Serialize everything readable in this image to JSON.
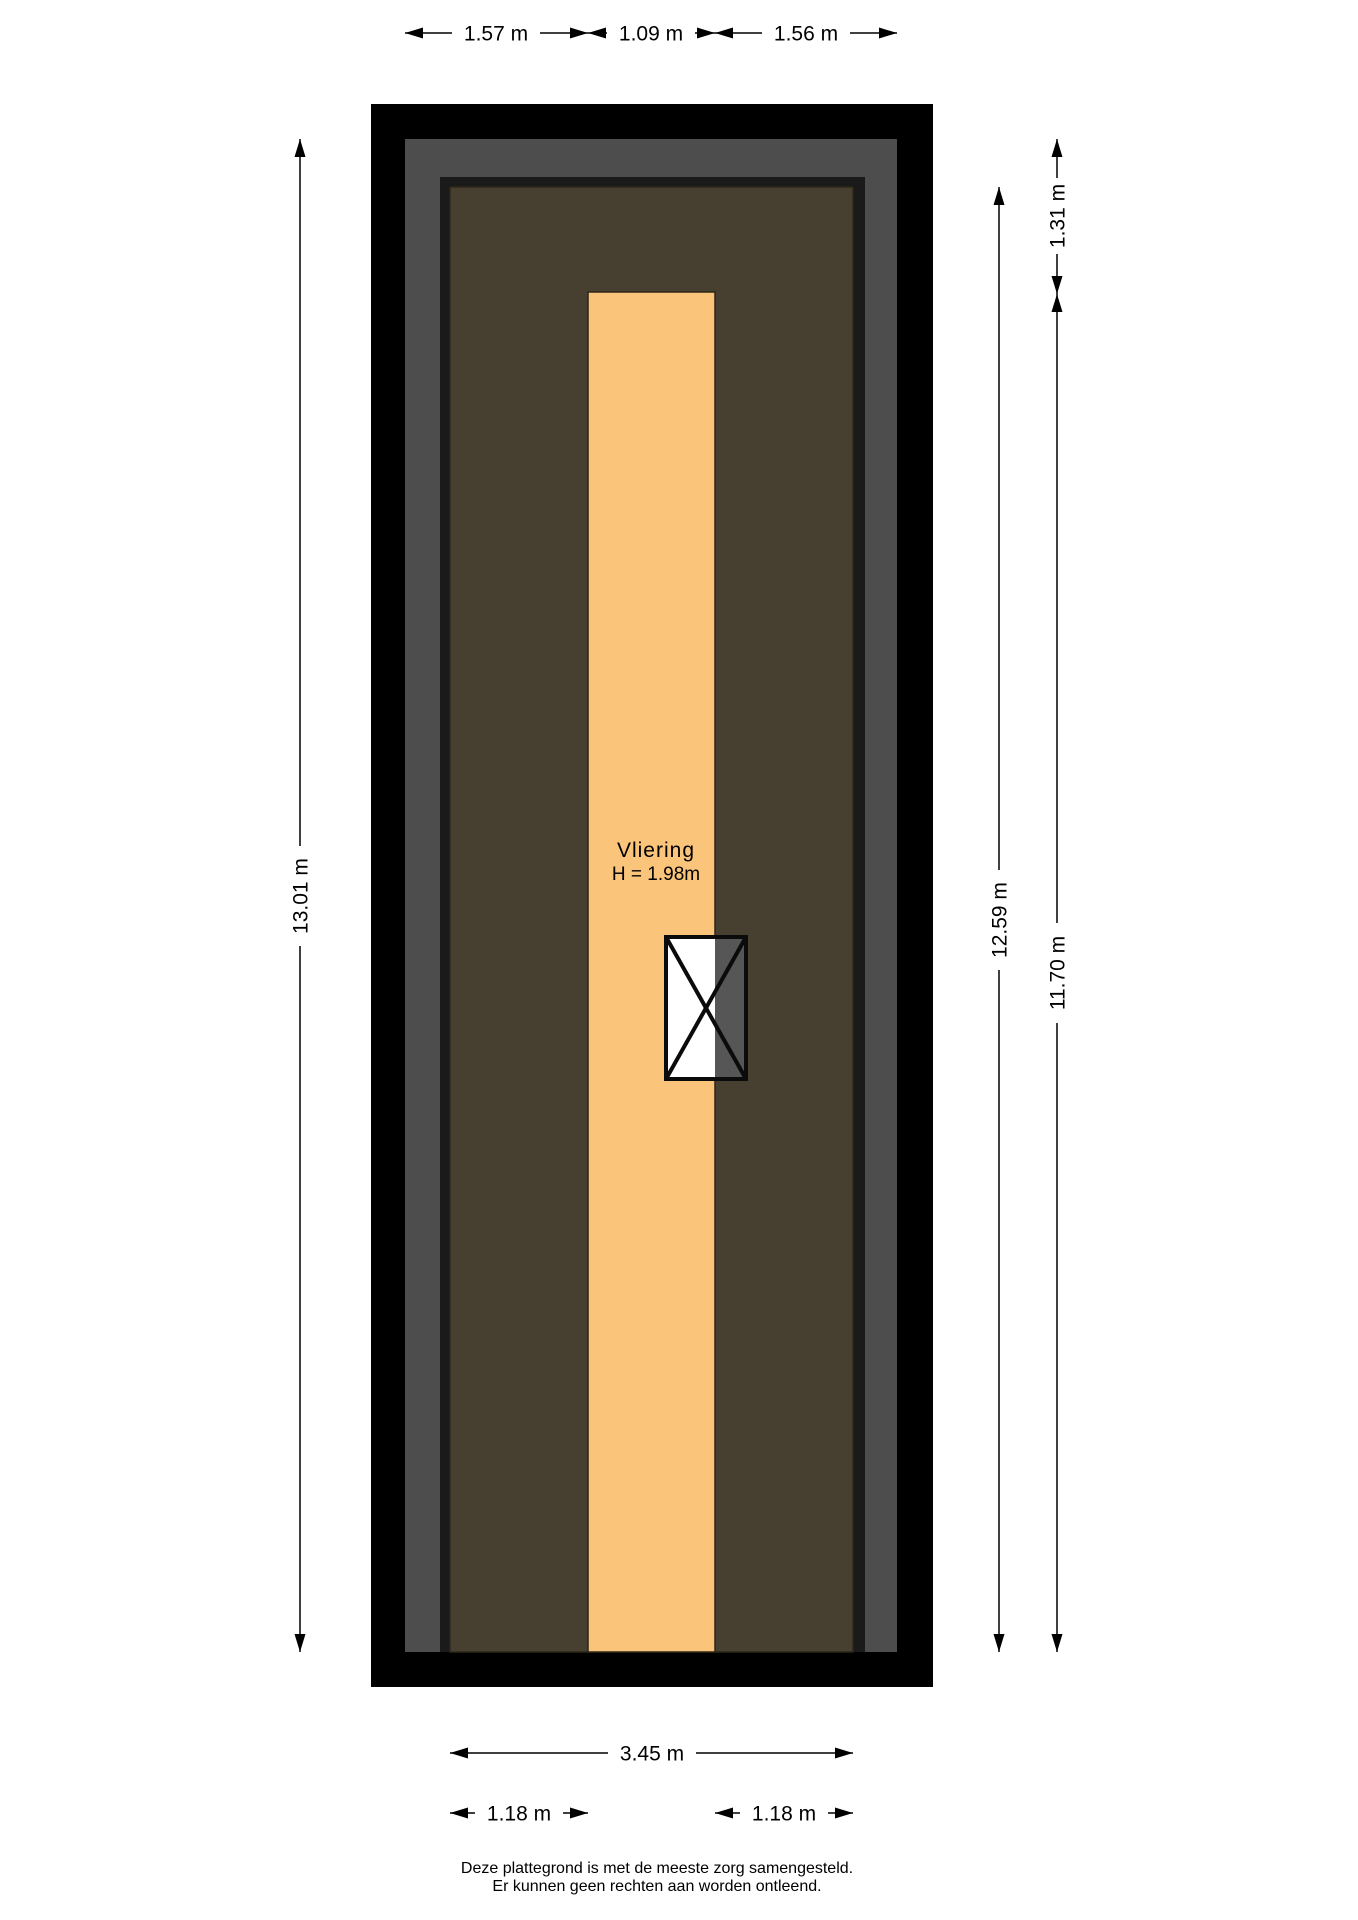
{
  "floorplan": {
    "room": {
      "name": "Vliering",
      "height": "H = 1.98m"
    },
    "colors": {
      "wall": "#000000",
      "roof_band": "#4d4d4d",
      "inner_frame": "#1a1a1a",
      "floor": "#474031",
      "loft_floor": "#fac47a",
      "window_pane": "#ffffff",
      "window_shade": "#565656"
    },
    "dimensions": {
      "top_left": "1.57 m",
      "top_middle": "1.09 m",
      "top_right": "1.56 m",
      "left_total": "13.01 m",
      "right_floor_depth": "12.59 m",
      "right_top": "1.31 m",
      "right_loft_depth": "11.70 m",
      "bottom_width": "3.45 m",
      "bottom_left": "1.18 m",
      "bottom_right": "1.18 m"
    }
  },
  "footer": {
    "line1": "Deze plattegrond is met de meeste zorg samengesteld.",
    "line2": "Er kunnen geen rechten aan worden ontleend."
  }
}
